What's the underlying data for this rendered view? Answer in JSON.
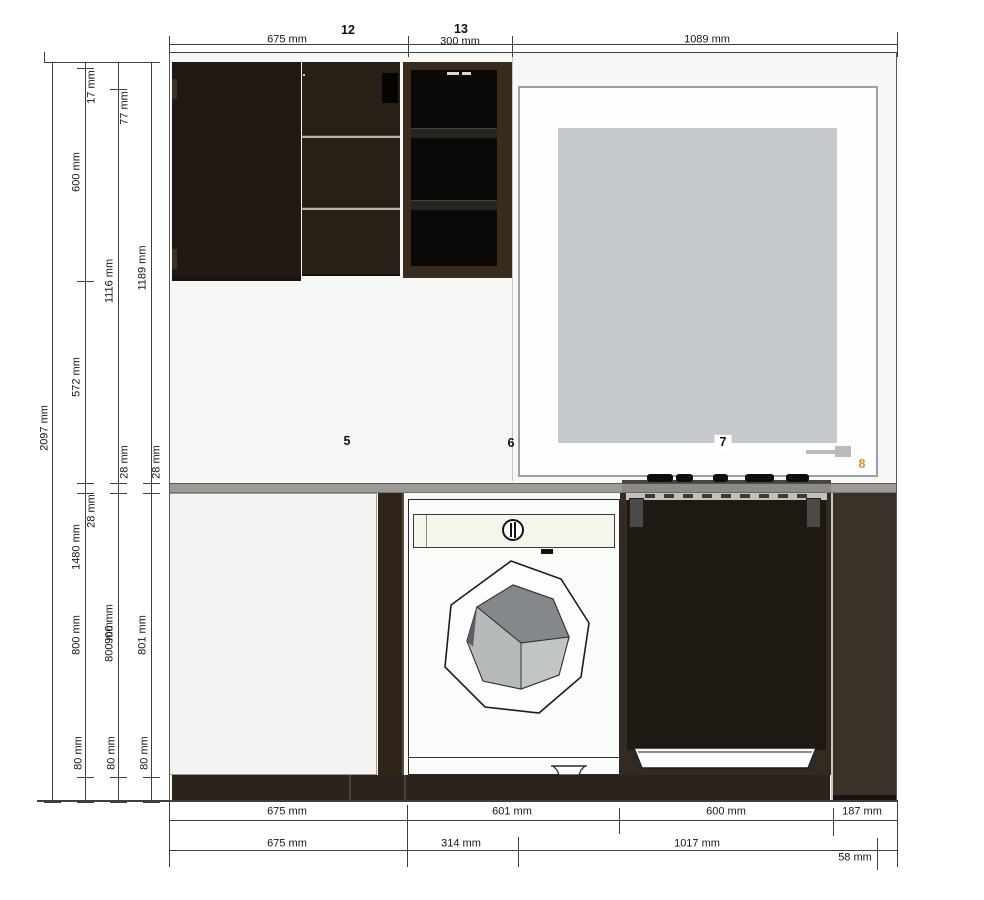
{
  "colors": {
    "accent_orange": "#e0912f",
    "counter_grey": "#9d9b97",
    "cabinet_dark": "#241c15",
    "window_panel_grey": "#c6c9cb",
    "wall_background": "#f7f7f6",
    "dimension_line": "#3f3f3f"
  },
  "unit": "mm",
  "labels": {
    "top": [
      {
        "id": "dim-top-width-675",
        "text": "675 mm",
        "x": 287,
        "y": 40,
        "rot": false
      },
      {
        "id": "item-number-12",
        "text": "12",
        "x": 348,
        "y": 30,
        "rot": false,
        "item": true
      },
      {
        "id": "dim-top-width-300",
        "text": "300 mm",
        "x": 460,
        "y": 42,
        "rot": false
      },
      {
        "id": "item-number-13",
        "text": "13",
        "x": 461,
        "y": 29,
        "rot": false,
        "item": true
      },
      {
        "id": "dim-top-width-1089",
        "text": "1089 mm",
        "x": 707,
        "y": 40,
        "rot": false
      }
    ],
    "left": [
      {
        "id": "dim-left-total-2097",
        "text": "2097 mm",
        "x": 45,
        "y": 428,
        "rot": true
      },
      {
        "id": "dim-left-17",
        "text": "17 mm",
        "x": 92,
        "y": 87,
        "rot": true
      },
      {
        "id": "dim-left-600",
        "text": "600 mm",
        "x": 77,
        "y": 172,
        "rot": true
      },
      {
        "id": "dim-left-1116",
        "text": "1116 mm",
        "x": 110,
        "y": 281,
        "rot": true
      },
      {
        "id": "dim-left-1189",
        "text": "1189 mm",
        "x": 143,
        "y": 268,
        "rot": true
      },
      {
        "id": "dim-left-77",
        "text": "77 mm",
        "x": 125,
        "y": 108,
        "rot": true
      },
      {
        "id": "dim-left-572",
        "text": "572 mm",
        "x": 77,
        "y": 377,
        "rot": true
      },
      {
        "id": "dim-left-28-a",
        "text": "28 mm",
        "x": 125,
        "y": 462,
        "rot": true
      },
      {
        "id": "dim-left-28-b",
        "text": "28 mm",
        "x": 157,
        "y": 462,
        "rot": true
      },
      {
        "id": "dim-left-28-c",
        "text": "28 mm",
        "x": 92,
        "y": 511,
        "rot": true
      },
      {
        "id": "dim-left-1480",
        "text": "1480 mm",
        "x": 77,
        "y": 547,
        "rot": true
      },
      {
        "id": "dim-left-800-a",
        "text": "800 mm",
        "x": 77,
        "y": 635,
        "rot": true
      },
      {
        "id": "dim-left-900",
        "text": "900 mm",
        "x": 110,
        "y": 624,
        "rot": true
      },
      {
        "id": "dim-left-800-b",
        "text": "800 mm",
        "x": 110,
        "y": 642,
        "rot": true
      },
      {
        "id": "dim-left-801",
        "text": "801 mm",
        "x": 143,
        "y": 635,
        "rot": true
      },
      {
        "id": "dim-left-80-a",
        "text": "80 mm",
        "x": 79,
        "y": 753,
        "rot": true
      },
      {
        "id": "dim-left-80-b",
        "text": "80 mm",
        "x": 112,
        "y": 753,
        "rot": true
      },
      {
        "id": "dim-left-80-c",
        "text": "80 mm",
        "x": 145,
        "y": 753,
        "rot": true
      }
    ],
    "bottom": [
      {
        "id": "dim-bottom-675-row1",
        "text": "675 mm",
        "x": 287,
        "y": 812,
        "rot": false
      },
      {
        "id": "dim-bottom-601",
        "text": "601 mm",
        "x": 512,
        "y": 812,
        "rot": false
      },
      {
        "id": "dim-bottom-600",
        "text": "600 mm",
        "x": 726,
        "y": 812,
        "rot": false
      },
      {
        "id": "dim-bottom-187",
        "text": "187 mm",
        "x": 862,
        "y": 812,
        "rot": false
      },
      {
        "id": "dim-bottom-675-row2",
        "text": "675 mm",
        "x": 287,
        "y": 844,
        "rot": false
      },
      {
        "id": "dim-bottom-314",
        "text": "314 mm",
        "x": 461,
        "y": 844,
        "rot": false
      },
      {
        "id": "dim-bottom-1017",
        "text": "1017 mm",
        "x": 697,
        "y": 844,
        "rot": false
      },
      {
        "id": "dim-bottom-58",
        "text": "58 mm",
        "x": 855,
        "y": 858,
        "rot": false
      }
    ],
    "items": [
      {
        "id": "item-number-5",
        "text": "5",
        "x": 347,
        "y": 441,
        "rot": false,
        "item": true
      },
      {
        "id": "item-number-6",
        "text": "6",
        "x": 511,
        "y": 443,
        "rot": false,
        "item": true
      },
      {
        "id": "item-number-7",
        "text": "7",
        "x": 723,
        "y": 442,
        "rot": false,
        "item": true,
        "chip": true
      },
      {
        "id": "item-number-8",
        "text": "8",
        "x": 862,
        "y": 464,
        "rot": false,
        "item": true,
        "color": "#e0912f"
      }
    ]
  }
}
